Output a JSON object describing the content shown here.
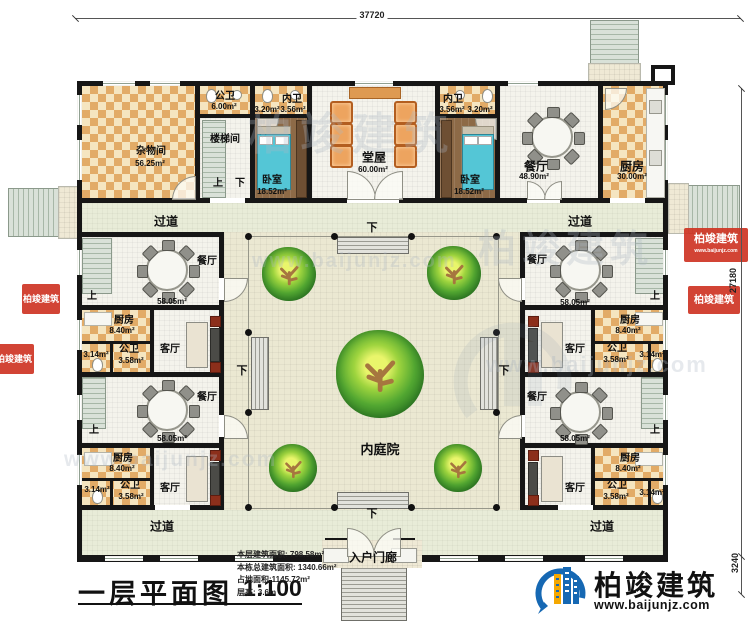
{
  "dimensions": {
    "top": "37720",
    "right": "27180",
    "right_lower": "3240"
  },
  "title_block": {
    "title": "一层平面图",
    "scale": "1:100"
  },
  "info": {
    "line1": "本层建筑面积: 798.58m²",
    "line2": "本栋总建筑面积: 1340.66m²",
    "line3": "占地面积:1145.72m²",
    "line4": "层高: 3.6m"
  },
  "brand": {
    "name": "柏竣建筑",
    "url": "www.baijunjz.com"
  },
  "labels": {
    "corridor": "过道",
    "courtyard": "内庭院",
    "porch": "入户门廊",
    "up": "上",
    "down": "下"
  },
  "rooms": {
    "storage": {
      "label": "杂物间",
      "area": "56.25m²"
    },
    "public_bath_top": {
      "label": "公卫",
      "area": "6.00m²"
    },
    "stair_room": {
      "label": "楼梯间"
    },
    "inner_bath_left": {
      "label": "内卫",
      "area_a": "3.20m²",
      "area_b": "3.56m²"
    },
    "inner_bath_right": {
      "label": "内卫",
      "area_a": "3.56m²",
      "area_b": "3.20m²"
    },
    "bedroom": {
      "label": "卧室",
      "area": "18.52m²"
    },
    "hall": {
      "label": "堂屋",
      "area": "60.00m²"
    },
    "dining_main": {
      "label": "餐厅",
      "area": "48.90m²"
    },
    "kitchen_main": {
      "label": "厨房",
      "area": "30.00m²"
    },
    "dining_side": {
      "label": "餐厅",
      "area": "58.05m²"
    },
    "kitchen_side": {
      "label": "厨房",
      "area": "8.40m²"
    },
    "bath_side": {
      "label": "公卫",
      "area_a": "3.58m²",
      "area_b": "3.14m²"
    },
    "living": {
      "label": "客厅"
    }
  },
  "watermark": {
    "name": "柏竣建筑",
    "url": "www.baijunjz.com"
  }
}
